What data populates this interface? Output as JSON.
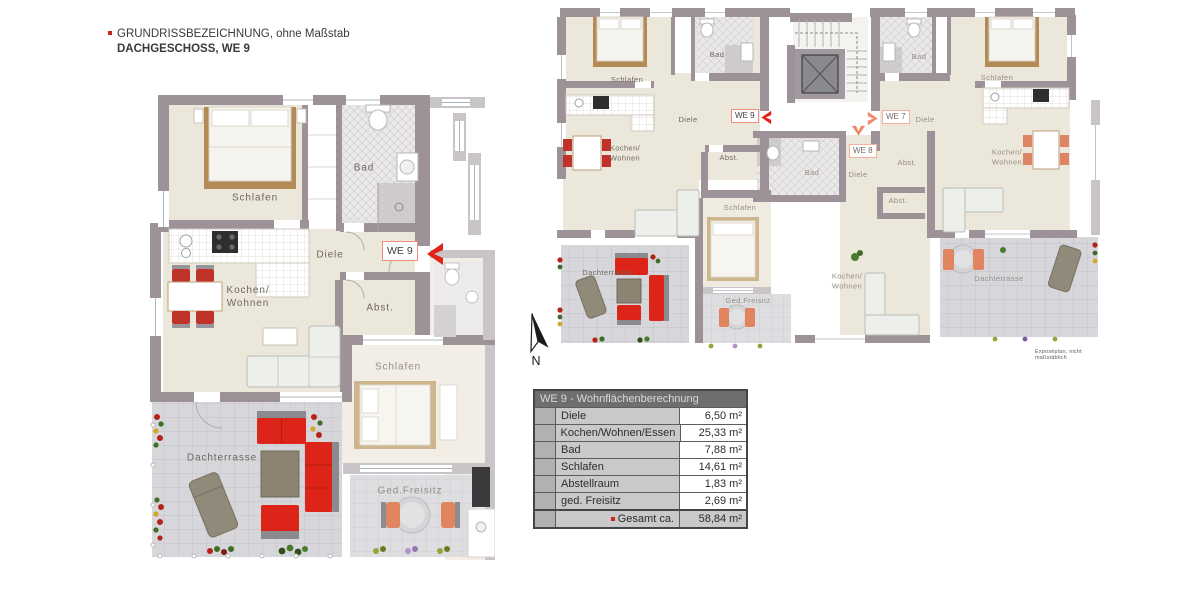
{
  "legend": {
    "line1": "GRUNDRISSBEZEICHNUNG, ohne Maßstab",
    "line2": "DACHGESCHOSS, WE 9"
  },
  "compass": {
    "north_label": "N"
  },
  "colors": {
    "wall": "#9c9298",
    "wall_light": "#c9c4c8",
    "floor": "#ece7db",
    "terrace_tile": "#d7d7db",
    "accent_red": "#e0241a",
    "accent_salmon": "#ef8a6a",
    "table_header_bg": "#6e6e70",
    "table_row_bg": "#c9c9cb"
  },
  "detail_plan": {
    "unit_badge": "WE 9",
    "rooms": {
      "schlafen": "Schlafen",
      "bad": "Bad",
      "diele": "Diele",
      "kochen_wohnen": "Kochen/\nWohnen",
      "abstellraum": "Abst.",
      "dachterrasse": "Dachterrasse",
      "schlafen_neighbor": "Schlafen",
      "ged_freisitz": "Ged.Freisitz"
    }
  },
  "overview_plan": {
    "unit_badges": {
      "we9": "WE 9",
      "we7": "WE 7",
      "we8": "WE 8"
    },
    "we9_rooms": {
      "schlafen": "Schlafen",
      "bad": "Bad",
      "diele": "Diele",
      "kochen_wohnen": "Kochen/\nWohnen",
      "abstellraum": "Abst.",
      "dachterrasse": "Dachterrasse"
    },
    "we8_rooms": {
      "schlafen": "Schlafen",
      "ged_freisitz": "Ged.Freisitz",
      "bad": "Bad",
      "diele": "Diele",
      "abstellraum": "Abst.",
      "kochen_wohnen": "Kochen/\nWohnen"
    },
    "we7_rooms": {
      "bad": "Bad",
      "schlafen": "Schlafen",
      "diele": "Diele",
      "kochen_wohnen": "Kochen/\nWohnen",
      "abstellraum": "Abst.",
      "dachterrasse": "Dachterrasse"
    },
    "disclaimer": "Exposéplan, nicht maßstäblich"
  },
  "area_table": {
    "title": "WE 9 - Wohnflächenberechnung",
    "rows": [
      {
        "label": "Diele",
        "value": "6,50 m²"
      },
      {
        "label": "Kochen/Wohnen/Essen",
        "value": "25,33 m²"
      },
      {
        "label": "Bad",
        "value": "7,88 m²"
      },
      {
        "label": "Schlafen",
        "value": "14,61 m²"
      },
      {
        "label": "Abstellraum",
        "value": "1,83 m²"
      },
      {
        "label": "ged. Freisitz",
        "value": "2,69 m²"
      }
    ],
    "total_label": "Gesamt ca.",
    "total_value": "58,84 m²"
  }
}
